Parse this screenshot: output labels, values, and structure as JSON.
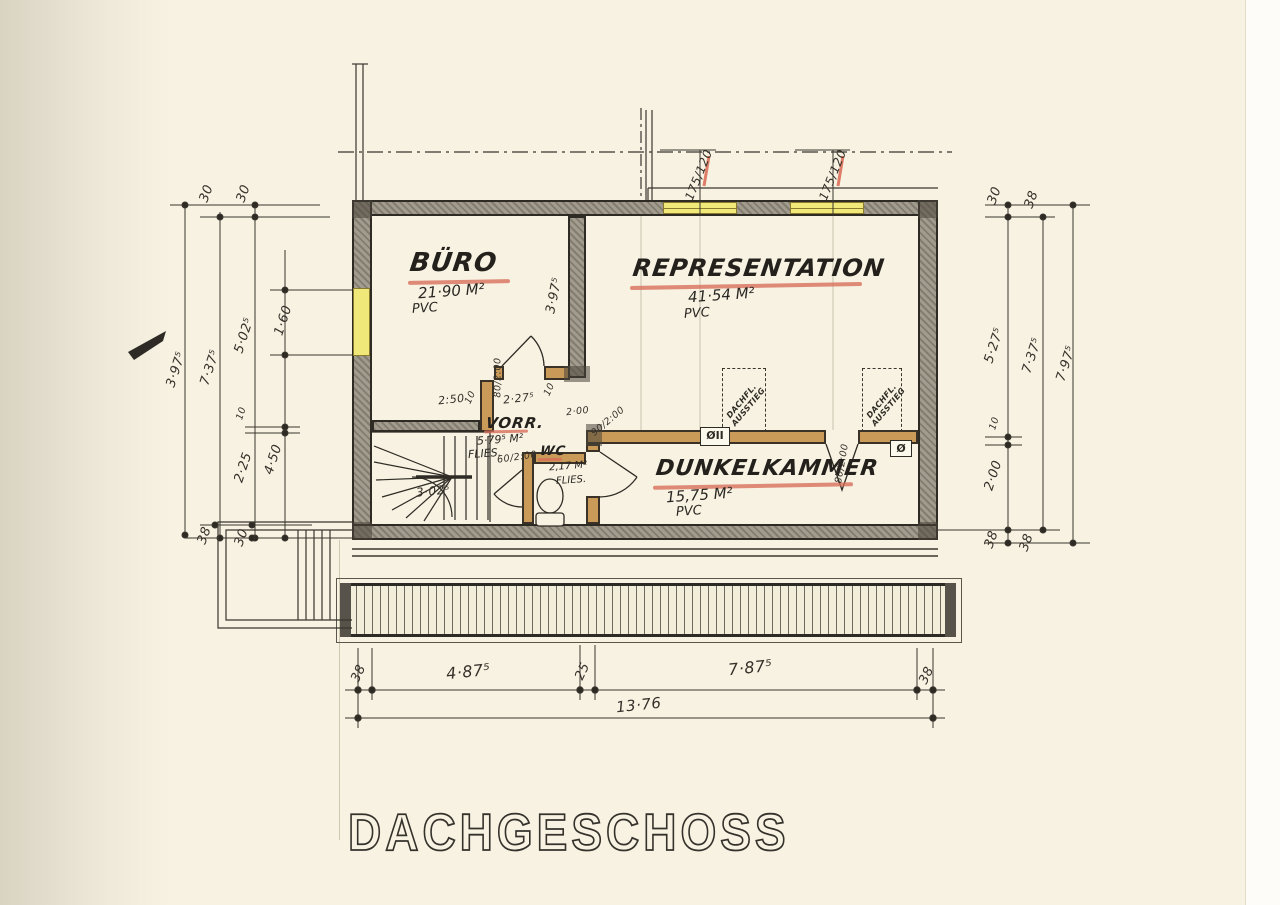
{
  "title": "DACHGESCHOSS",
  "rooms": [
    {
      "name": "BÜRO",
      "area": "21·90 M²",
      "floor": "PVC"
    },
    {
      "name": "REPRESENTATION",
      "area": "41·54 M²",
      "floor": "PVC"
    },
    {
      "name": "DUNKELKAMMER",
      "area": "15,75 M²",
      "floor": "PVC"
    },
    {
      "name": "VORR.",
      "area": "5·79⁵ M²",
      "floor": "FLIES."
    },
    {
      "name": "WC",
      "area": "2,17 M²",
      "floor": "FLIES."
    }
  ],
  "features": {
    "roof_hatch_label": "DACHFL. AUSSTIEG",
    "wall_symbol_1": "ØII",
    "wall_symbol_2": "Ø"
  },
  "windows": {
    "roof_window_1": "175/120",
    "roof_window_2": "175/120"
  },
  "doors": {
    "buero": "80/2:00",
    "dunkelkammer": "90/2:00",
    "wc": "60/2:00",
    "middle": "80/2:00"
  },
  "dims": {
    "left": {
      "t1": "30",
      "t2": "30",
      "c1": "3·97⁵",
      "c2": "7·37⁵",
      "c3": "5·02⁵",
      "c4": "1·60",
      "g1": "10",
      "c5": "2·25",
      "c6": "4·50",
      "b1": "38",
      "b2": "30"
    },
    "right": {
      "t1": "30",
      "t2": "38",
      "c1": "5·27⁵",
      "c2": "7·37⁵",
      "c3": "7·97⁵",
      "g1": "10",
      "c4": "2·00",
      "b1": "38",
      "b2": "38"
    },
    "bottom": {
      "w1": "38",
      "s1": "4·87⁵",
      "s2": "25",
      "s3": "7·87⁵",
      "w2": "38",
      "total": "13·76"
    },
    "interior": {
      "wall": "3·97⁵",
      "a": "2:50",
      "b": "10",
      "c": "2·27⁵",
      "d": "10",
      "e": "2·00",
      "stairs": "3·02⁵"
    }
  },
  "colors": {
    "paper": "#f7f2e2",
    "ink": "#2e2b24",
    "wall_fill": "#a29c8e",
    "tan": "#c99a58",
    "yellow": "#f0e878",
    "red": "#d86b58"
  }
}
